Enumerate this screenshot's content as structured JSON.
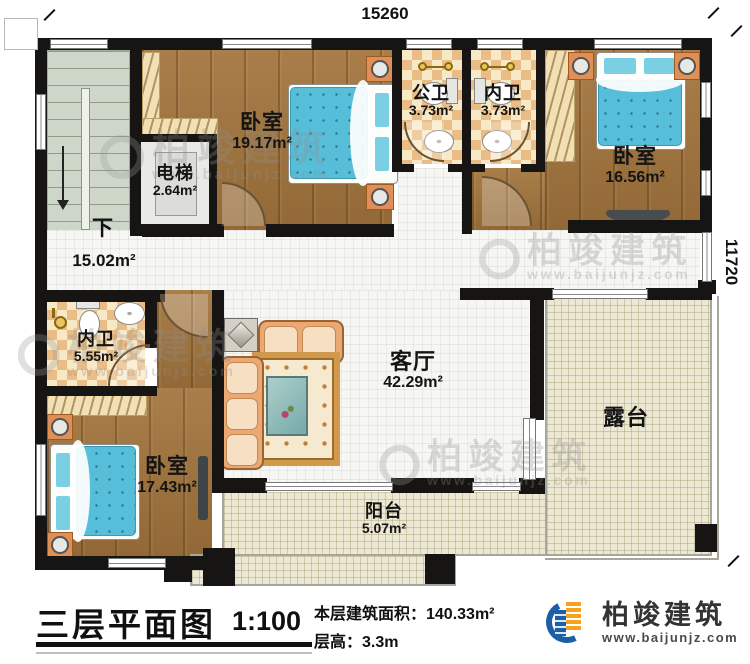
{
  "plan": {
    "dim_top": "15260",
    "dim_right": "11720",
    "stair_down_label": "下",
    "rooms": {
      "bedroom_top_left": {
        "name": "卧室",
        "area": "19.17m²"
      },
      "elevator": {
        "name": "电梯",
        "area": "2.64m²"
      },
      "bath_public": {
        "name": "公卫",
        "area": "3.73m²"
      },
      "bath_inner_top": {
        "name": "内卫",
        "area": "3.73m²"
      },
      "bedroom_top_right": {
        "name": "卧室",
        "area": "16.56m²"
      },
      "hallway": {
        "area": "15.02m²"
      },
      "bath_inner_bottom": {
        "name": "内卫",
        "area": "5.55m²"
      },
      "bedroom_bottom_left": {
        "name": "卧室",
        "area": "17.43m²"
      },
      "living_room": {
        "name": "客厅",
        "area": "42.29m²"
      },
      "terrace": {
        "name": "露台"
      },
      "balcony": {
        "name": "阳台",
        "area": "5.07m²"
      }
    },
    "watermark": {
      "text": "柏竣建筑",
      "url": "www.baijunjz.com"
    }
  },
  "footer": {
    "title": "三层平面图",
    "scale": "1:100",
    "area_line": "本层建筑面积：140.33m²",
    "floor_height_line": "层高：3.3m",
    "brand_name": "柏竣建筑",
    "brand_url": "www.baijunjz.com",
    "brand_colors": {
      "blue": "#1a5fa8",
      "orange": "#f6a21c"
    }
  }
}
